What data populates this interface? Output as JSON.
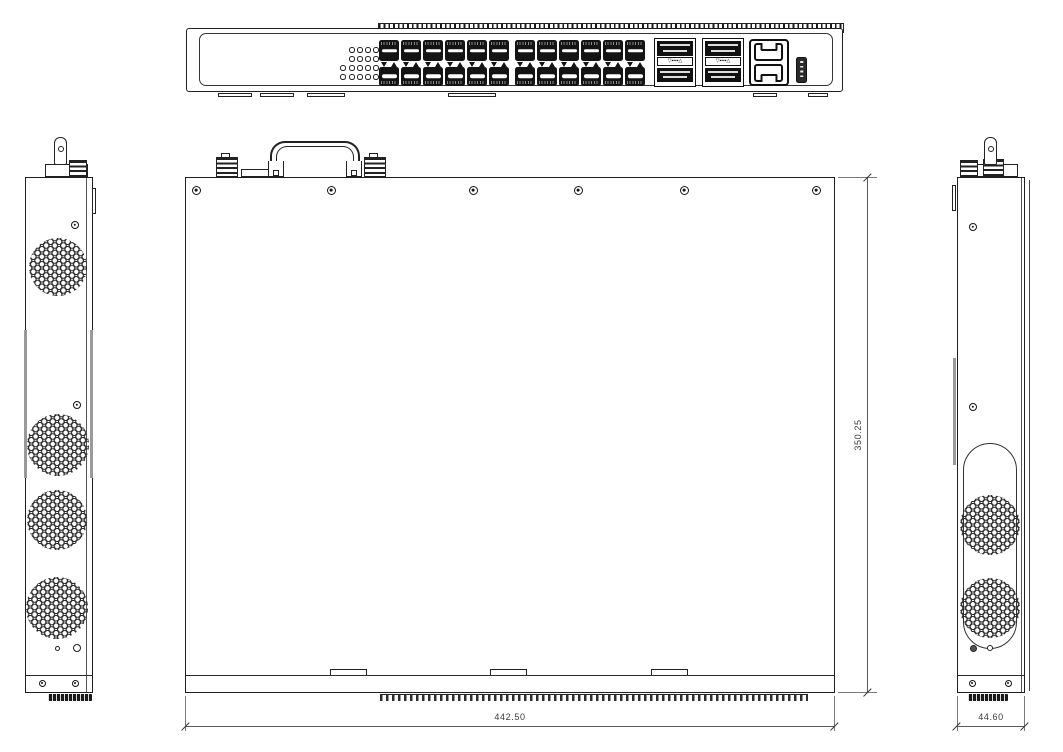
{
  "drawing_title": "1U rackmount network switch — mechanical outline drawing (front, top, left, right views)",
  "colors": {
    "ink": "#1f1f1f",
    "dim": "#4a4a4a",
    "background": "#ffffff"
  },
  "dimensions": {
    "width_label": "442.50",
    "depth_label": "350.25",
    "height_label": "44.60"
  },
  "front_view": {
    "led_rows": [
      4,
      4,
      5,
      5
    ],
    "sfp_groups": [
      6,
      6
    ],
    "sfp_rows": 2,
    "qsfp_modules": 2,
    "qsfp_ports_per_module": 2,
    "qsfp_label": "▽▪▪▪▪△",
    "rj45_ports": 2,
    "usb_ports": 1,
    "feet_count": 6
  },
  "top_view": {
    "screws": 6,
    "bottom_clip_tabs": 3,
    "top_terminal_blocks": 2,
    "handle": 1
  },
  "left_side_view": {
    "vents": 4,
    "body_screws": 2,
    "bottom_screws": 2,
    "small_holes": 2
  },
  "right_side_view": {
    "vents": 2,
    "body_screws": 2,
    "bottom_screws": 2,
    "small_holes": 2
  }
}
